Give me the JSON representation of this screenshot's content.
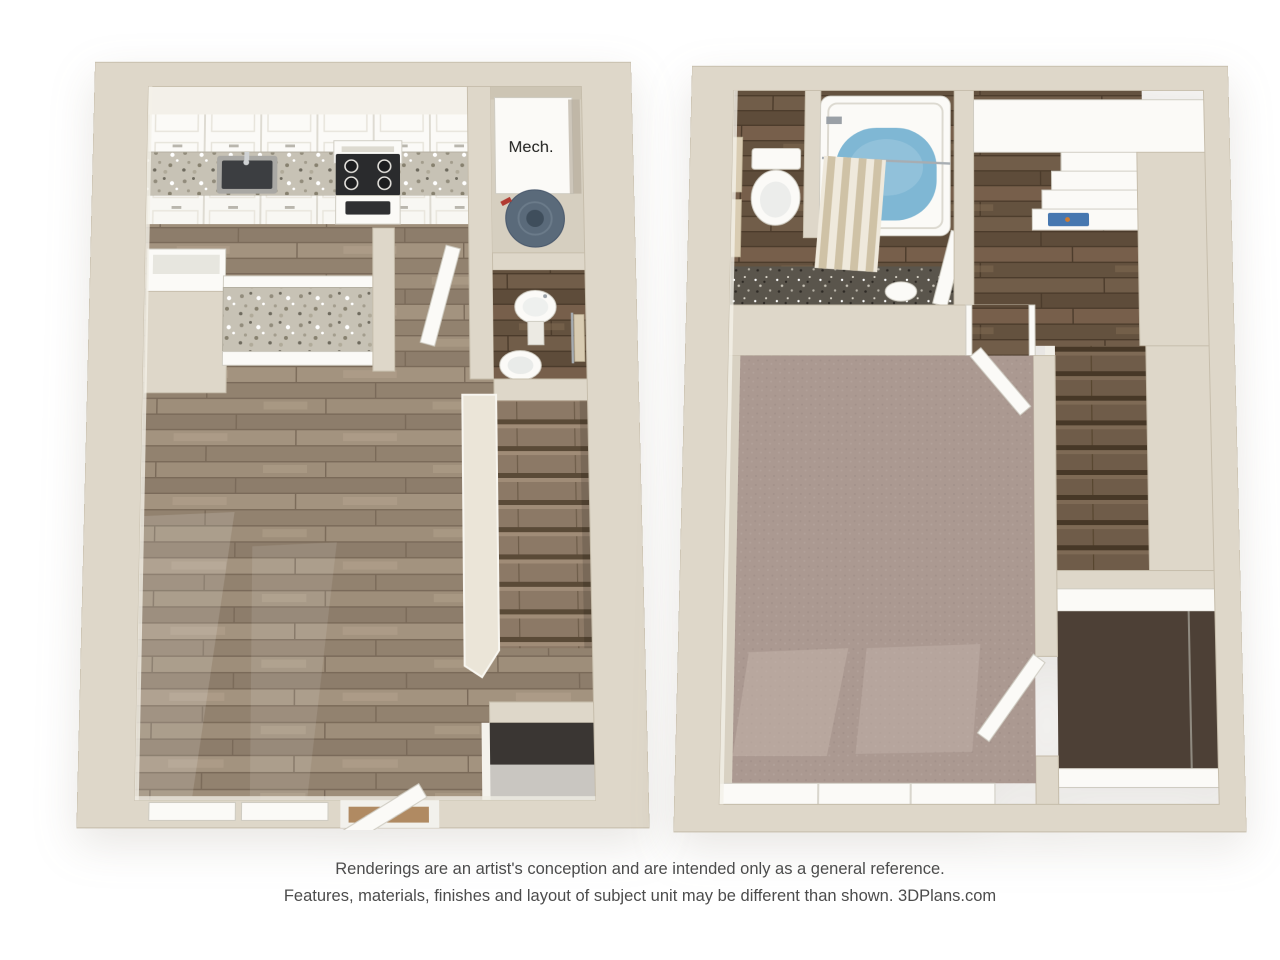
{
  "page": {
    "background_color": "#ffffff"
  },
  "plans": {
    "first_floor": {
      "mech_label": "Mech.",
      "rooms": [
        "kitchen",
        "mechanical-closet",
        "half-bathroom",
        "living-room",
        "staircase",
        "entry-closet"
      ],
      "fixtures": [
        "upper-cabinets",
        "granite-counter",
        "kitchen-sink",
        "range-hood",
        "range",
        "kitchen-island",
        "water-heater",
        "pedestal-sink",
        "toilet",
        "towel-bar",
        "front-door",
        "door-mat",
        "windows"
      ]
    },
    "second_floor": {
      "rooms": [
        "bathroom",
        "linen-closet",
        "landing",
        "staircase",
        "bedroom",
        "bedroom-closet"
      ],
      "fixtures": [
        "toilet",
        "bathtub",
        "shower-curtain",
        "towel-bars",
        "tile-floor",
        "shelves",
        "storage-bin",
        "bedroom-door",
        "closet-door",
        "closet-shelves",
        "window"
      ]
    }
  },
  "disclaimer": {
    "line1": "Renderings are an artist's conception and are intended only as a general reference.",
    "line2": "Features, materials, finishes and layout of subject unit may be different than shown. 3DPlans.com"
  },
  "colors": {
    "background": "#ffffff",
    "wall": "#ded7c9",
    "wall_edge": "#c6bdab",
    "wall_shadow": "#cdc5b4",
    "fixture_white": "#fbfaf7",
    "wood_floor": "#9c8c7b",
    "wood_floor_dark": "#6d5a48",
    "stair_wood": "#8c7966",
    "granite": "#c7c2b5",
    "bath_tile": "#5a554c",
    "carpet": "#ab9991",
    "closet_carpet": "#4d4036",
    "water": "#7fb7d4",
    "water_heater": "#5a6a7a",
    "towel": "#d9ccb2",
    "door_mat": "#b08a62",
    "label_text": "#1d1d1b",
    "disclaimer_text": "#4c4c4c"
  }
}
